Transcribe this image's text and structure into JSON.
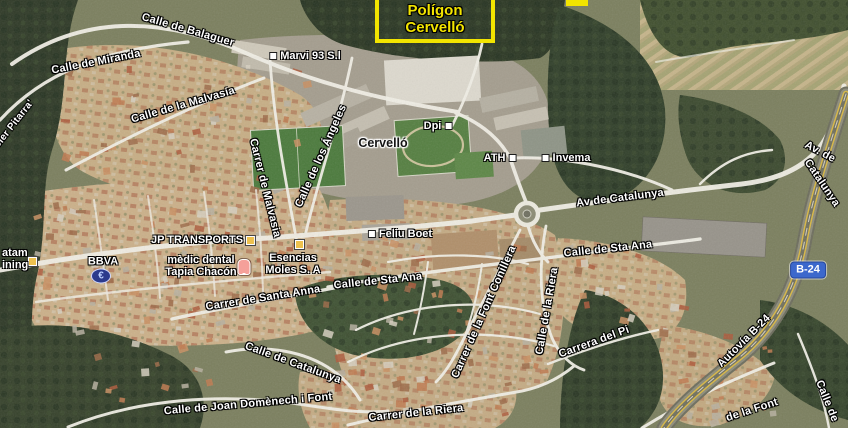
{
  "highlight": {
    "line1": "Polígon",
    "line2": "Cervelló"
  },
  "town": "Cervelló",
  "shield": "B-24",
  "streets": [
    {
      "text": "Calle de Balaguer"
    },
    {
      "text": "Calle de Miranda"
    },
    {
      "text": "oler Pitarra'"
    },
    {
      "text": "Calle de la Malvasía"
    },
    {
      "text": "Carrer de Malvasia"
    },
    {
      "text": "Calle de los Ángeles"
    },
    {
      "text": "Av de Catalunya"
    },
    {
      "text": "Av. de"
    },
    {
      "text": "Catalunya"
    },
    {
      "text": "Calle de Sta Ana"
    },
    {
      "text": "Carrer de Santa Anna"
    },
    {
      "text": "Calle de Sta Ana"
    },
    {
      "text": "Calle de la Riera"
    },
    {
      "text": "Carrer de la Font Conillera"
    },
    {
      "text": "Carrera del Pi"
    },
    {
      "text": "Calle de Catalunya"
    },
    {
      "text": "Calle de Joan Domènech i Font"
    },
    {
      "text": "Carrer de la Riera"
    },
    {
      "text": "Autovía B-24"
    },
    {
      "text": "de la Font"
    },
    {
      "text": "Calle de"
    }
  ],
  "pois": [
    {
      "text": "Marvi 93 S.l"
    },
    {
      "text": "Dpi"
    },
    {
      "text": "ATH"
    },
    {
      "text": "Invema"
    },
    {
      "text": "Feliu Boet"
    }
  ],
  "businesses": {
    "jp": "JP TRANSPORTS",
    "bbva": "BBVA",
    "medic1": "mèdic dental",
    "medic2": "Tapia Chacón",
    "esencias1": "Esencias",
    "esencias2": "Moles S. A",
    "partial1": "atam",
    "partial2": "ining"
  },
  "icons": {
    "euro": "€"
  },
  "colors": {
    "highlight_yellow": "#f2e400",
    "shield_blue": "#3c68cc",
    "poi_icon_yellow": "#edc14e",
    "tooth_pink": "#f5a09a",
    "euro_blue": "#2b3a8c",
    "label_white": "#ffffff"
  }
}
